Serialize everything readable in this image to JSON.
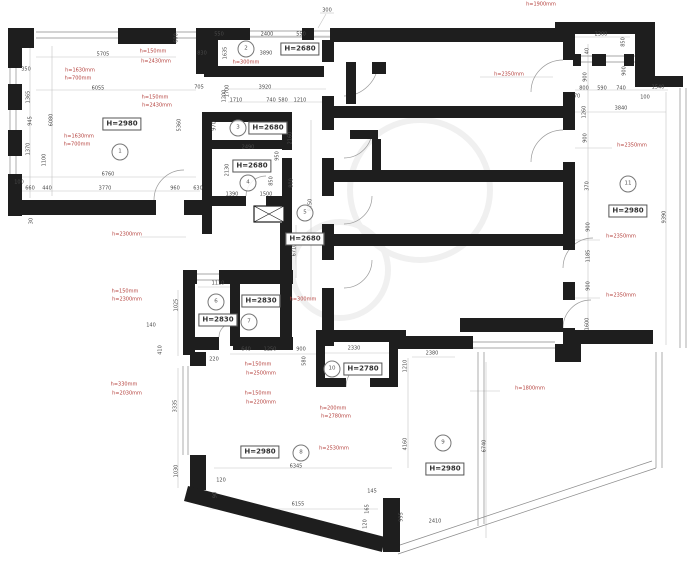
{
  "plan": {
    "type": "architectural-floor-plan",
    "colors": {
      "wall": "#1e1e1e",
      "dim_text": "#4a4a4a",
      "annotation_red": "#b5423e",
      "thin_line": "#8a8a8a",
      "dim_line": "#c3c3c3"
    },
    "rooms": [
      {
        "num": "1",
        "h": "H=2980",
        "circle": {
          "x": 120,
          "y": 152
        },
        "box": {
          "x": 122,
          "y": 124
        }
      },
      {
        "num": "2",
        "h": "H=2680",
        "circle": {
          "x": 246,
          "y": 49
        },
        "box": {
          "x": 300,
          "y": 49
        }
      },
      {
        "num": "3",
        "h": "H=2680",
        "circle": {
          "x": 238,
          "y": 128
        },
        "box": {
          "x": 268,
          "y": 128
        }
      },
      {
        "num": "4",
        "h": "H=2680",
        "circle": {
          "x": 248,
          "y": 183
        },
        "box": {
          "x": 252,
          "y": 166
        }
      },
      {
        "num": "5",
        "h": "H=2680",
        "circle": {
          "x": 305,
          "y": 213
        },
        "box": {
          "x": 305,
          "y": 239
        }
      },
      {
        "num": "6",
        "h": "H=2830",
        "circle": {
          "x": 216,
          "y": 302
        },
        "box": {
          "x": 218,
          "y": 320
        }
      },
      {
        "num": "7",
        "h": "H=2830",
        "circle": {
          "x": 249,
          "y": 322
        },
        "box": {
          "x": 261,
          "y": 301
        }
      },
      {
        "num": "8",
        "h": "H=2980",
        "circle": {
          "x": 301,
          "y": 453
        },
        "box": {
          "x": 260,
          "y": 452
        }
      },
      {
        "num": "9",
        "h": "H=2980",
        "circle": {
          "x": 443,
          "y": 443
        },
        "box": {
          "x": 445,
          "y": 469
        }
      },
      {
        "num": "10",
        "h": "H=2780",
        "circle": {
          "x": 332,
          "y": 369
        },
        "box": {
          "x": 363,
          "y": 369
        }
      },
      {
        "num": "11",
        "h": "H=2980",
        "circle": {
          "x": 628,
          "y": 184
        },
        "box": {
          "x": 628,
          "y": 211
        }
      }
    ],
    "dimensions": [
      {
        "t": "5705",
        "x": 103,
        "y": 55
      },
      {
        "t": "6055",
        "x": 98,
        "y": 89
      },
      {
        "t": "350",
        "x": 26,
        "y": 70
      },
      {
        "t": "1365",
        "x": 29,
        "y": 97,
        "r": -90
      },
      {
        "t": "945",
        "x": 31,
        "y": 121,
        "r": -90
      },
      {
        "t": "6080",
        "x": 52,
        "y": 120,
        "r": -90
      },
      {
        "t": "1370",
        "x": 29,
        "y": 149,
        "r": -90
      },
      {
        "t": "1100",
        "x": 45,
        "y": 160,
        "r": -90
      },
      {
        "t": "100",
        "x": 19,
        "y": 183
      },
      {
        "t": "660",
        "x": 30,
        "y": 189
      },
      {
        "t": "440",
        "x": 47,
        "y": 189
      },
      {
        "t": "6760",
        "x": 108,
        "y": 175
      },
      {
        "t": "3770",
        "x": 105,
        "y": 189
      },
      {
        "t": "960",
        "x": 175,
        "y": 189
      },
      {
        "t": "630",
        "x": 198,
        "y": 189
      },
      {
        "t": "30",
        "x": 32,
        "y": 221,
        "r": -90
      },
      {
        "t": "600",
        "x": 177,
        "y": 38,
        "r": -90
      },
      {
        "t": "830",
        "x": 202,
        "y": 54
      },
      {
        "t": "1635",
        "x": 226,
        "y": 53,
        "r": -90
      },
      {
        "t": "705",
        "x": 199,
        "y": 88
      },
      {
        "t": "5360",
        "x": 180,
        "y": 125,
        "r": -90
      },
      {
        "t": "1200",
        "x": 225,
        "y": 96,
        "r": -90
      },
      {
        "t": "550",
        "x": 219,
        "y": 35
      },
      {
        "t": "2400",
        "x": 267,
        "y": 35
      },
      {
        "t": "550",
        "x": 301,
        "y": 35
      },
      {
        "t": "300",
        "x": 327,
        "y": 11
      },
      {
        "t": "3890",
        "x": 266,
        "y": 54
      },
      {
        "t": "1700",
        "x": 228,
        "y": 91,
        "r": -90
      },
      {
        "t": "3920",
        "x": 265,
        "y": 88
      },
      {
        "t": "1710",
        "x": 236,
        "y": 101
      },
      {
        "t": "740",
        "x": 271,
        "y": 101
      },
      {
        "t": "580",
        "x": 283,
        "y": 101
      },
      {
        "t": "1210",
        "x": 300,
        "y": 101
      },
      {
        "t": "970",
        "x": 215,
        "y": 126,
        "r": -90
      },
      {
        "t": "2160",
        "x": 291,
        "y": 138,
        "r": -90
      },
      {
        "t": "2490",
        "x": 248,
        "y": 148
      },
      {
        "t": "950",
        "x": 278,
        "y": 156,
        "r": -90
      },
      {
        "t": "2130",
        "x": 228,
        "y": 170,
        "r": -90
      },
      {
        "t": "850",
        "x": 272,
        "y": 181,
        "r": -90
      },
      {
        "t": "800",
        "x": 292,
        "y": 183,
        "r": -90
      },
      {
        "t": "1390",
        "x": 232,
        "y": 195
      },
      {
        "t": "1500",
        "x": 266,
        "y": 195
      },
      {
        "t": "8750",
        "x": 311,
        "y": 205,
        "r": -90
      },
      {
        "t": "6710",
        "x": 295,
        "y": 250,
        "r": -90
      },
      {
        "t": "2300",
        "x": 601,
        "y": 35
      },
      {
        "t": "850",
        "x": 624,
        "y": 42,
        "r": -90
      },
      {
        "t": "40",
        "x": 588,
        "y": 51,
        "r": -90
      },
      {
        "t": "900",
        "x": 586,
        "y": 77,
        "r": -90
      },
      {
        "t": "900",
        "x": 625,
        "y": 71,
        "r": -90
      },
      {
        "t": "800",
        "x": 584,
        "y": 89
      },
      {
        "t": "590",
        "x": 602,
        "y": 89
      },
      {
        "t": "740",
        "x": 621,
        "y": 89
      },
      {
        "t": "1540",
        "x": 658,
        "y": 88
      },
      {
        "t": "70",
        "x": 577,
        "y": 97
      },
      {
        "t": "100",
        "x": 645,
        "y": 98
      },
      {
        "t": "1260",
        "x": 585,
        "y": 112,
        "r": -90
      },
      {
        "t": "3840",
        "x": 621,
        "y": 109
      },
      {
        "t": "900",
        "x": 586,
        "y": 138,
        "r": -90
      },
      {
        "t": "370",
        "x": 588,
        "y": 186,
        "r": -90
      },
      {
        "t": "900",
        "x": 589,
        "y": 227,
        "r": -90
      },
      {
        "t": "1185",
        "x": 589,
        "y": 256,
        "r": -90
      },
      {
        "t": "900",
        "x": 589,
        "y": 286,
        "r": -90
      },
      {
        "t": "1600",
        "x": 588,
        "y": 324,
        "r": -90
      },
      {
        "t": "9390",
        "x": 665,
        "y": 217,
        "r": -90
      },
      {
        "t": "640",
        "x": 246,
        "y": 350
      },
      {
        "t": "1250",
        "x": 270,
        "y": 350
      },
      {
        "t": "900",
        "x": 301,
        "y": 350
      },
      {
        "t": "2330",
        "x": 354,
        "y": 349
      },
      {
        "t": "220",
        "x": 214,
        "y": 360
      },
      {
        "t": "580",
        "x": 305,
        "y": 361,
        "r": -90
      },
      {
        "t": "6345",
        "x": 296,
        "y": 467
      },
      {
        "t": "120",
        "x": 221,
        "y": 481
      },
      {
        "t": "90",
        "x": 216,
        "y": 495,
        "r": -90
      },
      {
        "t": "6155",
        "x": 298,
        "y": 505
      },
      {
        "t": "145",
        "x": 372,
        "y": 492
      },
      {
        "t": "165",
        "x": 368,
        "y": 509,
        "r": -90
      },
      {
        "t": "120",
        "x": 366,
        "y": 524,
        "r": -90
      },
      {
        "t": "995",
        "x": 402,
        "y": 517,
        "r": -90
      },
      {
        "t": "2410",
        "x": 435,
        "y": 522
      },
      {
        "t": "2380",
        "x": 432,
        "y": 354
      },
      {
        "t": "1210",
        "x": 406,
        "y": 366,
        "r": -90
      },
      {
        "t": "4160",
        "x": 406,
        "y": 444,
        "r": -90
      },
      {
        "t": "6740",
        "x": 485,
        "y": 446,
        "r": -90
      },
      {
        "t": "1110",
        "x": 218,
        "y": 284
      },
      {
        "t": "1025",
        "x": 177,
        "y": 305,
        "r": -90
      },
      {
        "t": "140",
        "x": 151,
        "y": 326
      },
      {
        "t": "410",
        "x": 161,
        "y": 350,
        "r": -90
      },
      {
        "t": "3335",
        "x": 176,
        "y": 406,
        "r": -90
      },
      {
        "t": "1030",
        "x": 177,
        "y": 471,
        "r": -90
      }
    ],
    "annotations": [
      {
        "t": "h=150mm",
        "x": 153,
        "y": 52
      },
      {
        "t": "h=2430mm",
        "x": 156,
        "y": 62
      },
      {
        "t": "h=1630mm",
        "x": 80,
        "y": 71
      },
      {
        "t": "h=700mm",
        "x": 78,
        "y": 79
      },
      {
        "t": "h=150mm",
        "x": 155,
        "y": 98
      },
      {
        "t": "h=2430mm",
        "x": 157,
        "y": 106
      },
      {
        "t": "h=1630mm",
        "x": 79,
        "y": 137
      },
      {
        "t": "h=700mm",
        "x": 77,
        "y": 145
      },
      {
        "t": "h=2300mm",
        "x": 127,
        "y": 235
      },
      {
        "t": "h=300mm",
        "x": 246,
        "y": 63
      },
      {
        "t": "h=1900mm",
        "x": 541,
        "y": 5
      },
      {
        "t": "h=2350mm",
        "x": 509,
        "y": 75
      },
      {
        "t": "h=2350mm",
        "x": 632,
        "y": 146
      },
      {
        "t": "h=2350mm",
        "x": 621,
        "y": 237
      },
      {
        "t": "h=2350mm",
        "x": 621,
        "y": 296
      },
      {
        "t": "h=150mm",
        "x": 125,
        "y": 292
      },
      {
        "t": "h=2300mm",
        "x": 127,
        "y": 300
      },
      {
        "t": "h=330mm",
        "x": 124,
        "y": 385
      },
      {
        "t": "h=2030mm",
        "x": 127,
        "y": 394
      },
      {
        "t": "h=150mm",
        "x": 258,
        "y": 365
      },
      {
        "t": "h=2500mm",
        "x": 261,
        "y": 374
      },
      {
        "t": "h=150mm",
        "x": 258,
        "y": 394
      },
      {
        "t": "h=2200mm",
        "x": 261,
        "y": 403
      },
      {
        "t": "h=200mm",
        "x": 333,
        "y": 409
      },
      {
        "t": "h=2780mm",
        "x": 336,
        "y": 417
      },
      {
        "t": "h=2530mm",
        "x": 334,
        "y": 449
      },
      {
        "t": "h=1800mm",
        "x": 530,
        "y": 389
      },
      {
        "t": "h=300mm",
        "x": 303,
        "y": 300
      }
    ]
  }
}
